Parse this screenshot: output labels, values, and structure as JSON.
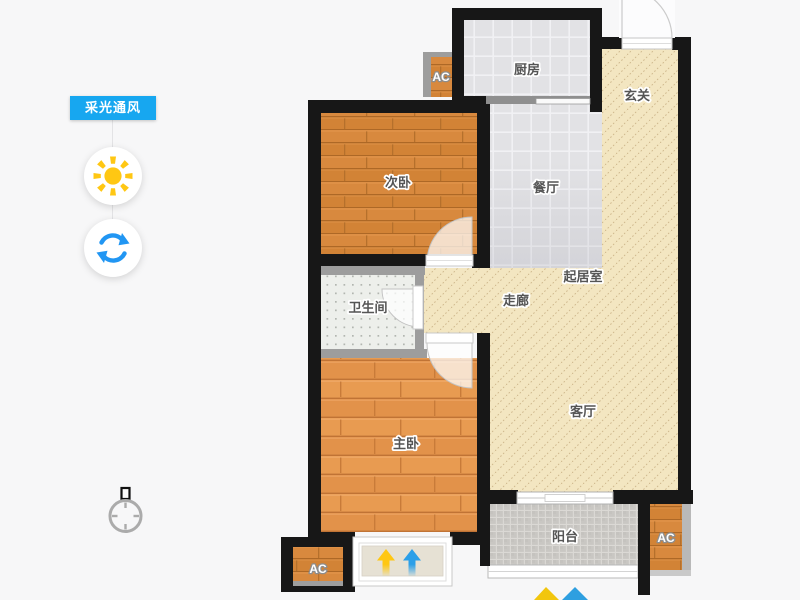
{
  "app": {
    "background": "#f7f7f8"
  },
  "sidebar": {
    "badge": {
      "label": "采光通风",
      "color": "#17a7f0"
    },
    "buttons": [
      {
        "id": "daylight",
        "icon": "sun-icon",
        "color": "#ffc713"
      },
      {
        "id": "ventilation",
        "icon": "refresh-icon",
        "color": "#2196f3"
      }
    ]
  },
  "floor_plan": {
    "wall_color": "#171717",
    "rooms": {
      "kitchen": "厨房",
      "entrance": "玄关",
      "bedroom_second": "次卧",
      "dining": "餐厅",
      "living_core": "起居室",
      "corridor": "走廊",
      "bathroom": "卫生间",
      "bedroom_master": "主卧",
      "living_room": "客厅",
      "balcony": "阳台"
    },
    "ac_label": "AC",
    "floor_colors": {
      "wood": "#d8893e",
      "wood_light": "#e89b51",
      "tile": "#e2e2e5",
      "cream": "#f3e6c1",
      "balcony_tile": "#c9c7c3",
      "bathroom": "#edefeb"
    },
    "annotations": {
      "arrow_yellow": "#ffc712",
      "arrow_blue": "#2b9fe8"
    }
  }
}
